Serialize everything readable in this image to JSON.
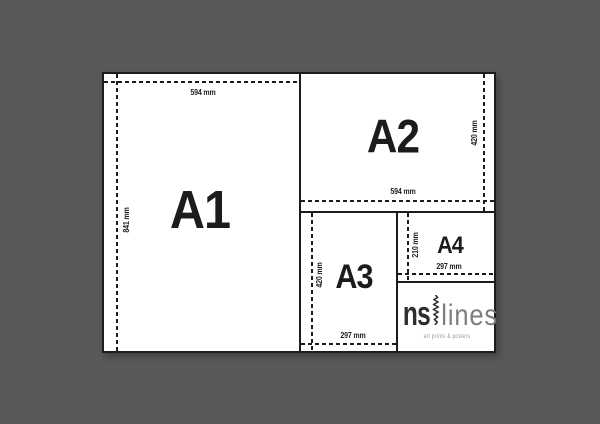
{
  "scene": {
    "background_color": "#58595b",
    "paper_color": "#ffffff",
    "line_color": "#1c1c1c"
  },
  "panels": {
    "a1": {
      "label": "A1",
      "width": "594 mm",
      "height": "841 mm"
    },
    "a2": {
      "label": "A2",
      "width": "594 mm",
      "height": "420 mm"
    },
    "a3": {
      "label": "A3",
      "width": "297 mm",
      "height": "420 mm"
    },
    "a4": {
      "label": "A4",
      "width": "297 mm",
      "height": "210 mm"
    }
  },
  "logo": {
    "name_left": "ns",
    "name_right": "lines",
    "tagline": "art prints & posters"
  }
}
